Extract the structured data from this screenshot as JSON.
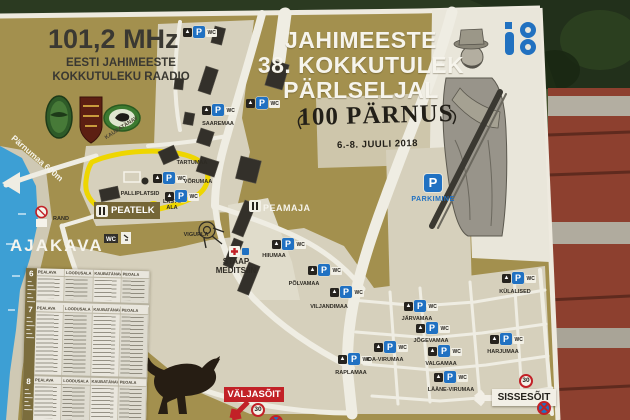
{
  "branding": {
    "frequency": "101,2 MHz",
    "radio_line1": "EESTI JAHIMEESTE",
    "radio_line2": "KOKKUTULEKU RAADIO",
    "title_line1": "JAHIMEESTE",
    "title_line2": "38. KOKKUTULEK",
    "title_line3": "PÄRLSELJAL",
    "anniversary": "100 PÄRNUS",
    "dates": "6.-8. JUULI 2018"
  },
  "map": {
    "schedule_heading": "AJAKAVA",
    "road_sign": "Pärnumaa 600m",
    "street": "KAUBATÄNAV",
    "beach": "RAND",
    "main_tent": "PEATELK",
    "ball_fields": "PALLIPLATSID",
    "kids_area": "LASTE ALA",
    "stunt_area": "VIGURLA",
    "main_building": "PEAMAJA",
    "hq_medical": "STAAP MEDITSIIN",
    "parking": "PARKIMINE",
    "exit": "VÄLJASÕIT",
    "entrance": "SISSESÕIT",
    "speed_limit": "30",
    "camps": [
      "SAAREMAA",
      "TARTUMAA",
      "VÕRUMAA",
      "HIIUMAA",
      "PÕLVAMAA",
      "VILJANDIMAA",
      "RAPLAMAA",
      "JÄRVAMAA",
      "JÕGEVAMAA",
      "IDA-VIRUMAA",
      "VALGAMAA",
      "LÄÄNE-VIRUMAA",
      "HARJUMAA",
      "KÜLALISED",
      "",
      ""
    ],
    "icons": {
      "tent_glyph": "▲",
      "parking_glyph": "P",
      "wc_label": "WC"
    }
  },
  "schedule": {
    "days": [
      "6",
      "7",
      "8"
    ],
    "columns": [
      "PEALAVA",
      "LOODUSALA",
      "KAUBATÄNAV",
      "PEOALA"
    ]
  },
  "colors": {
    "board": "#a3904e",
    "accent_red": "#c22127",
    "accent_blue": "#2071c2",
    "water": "#3d9fd4",
    "route_yellow": "#eed600"
  }
}
